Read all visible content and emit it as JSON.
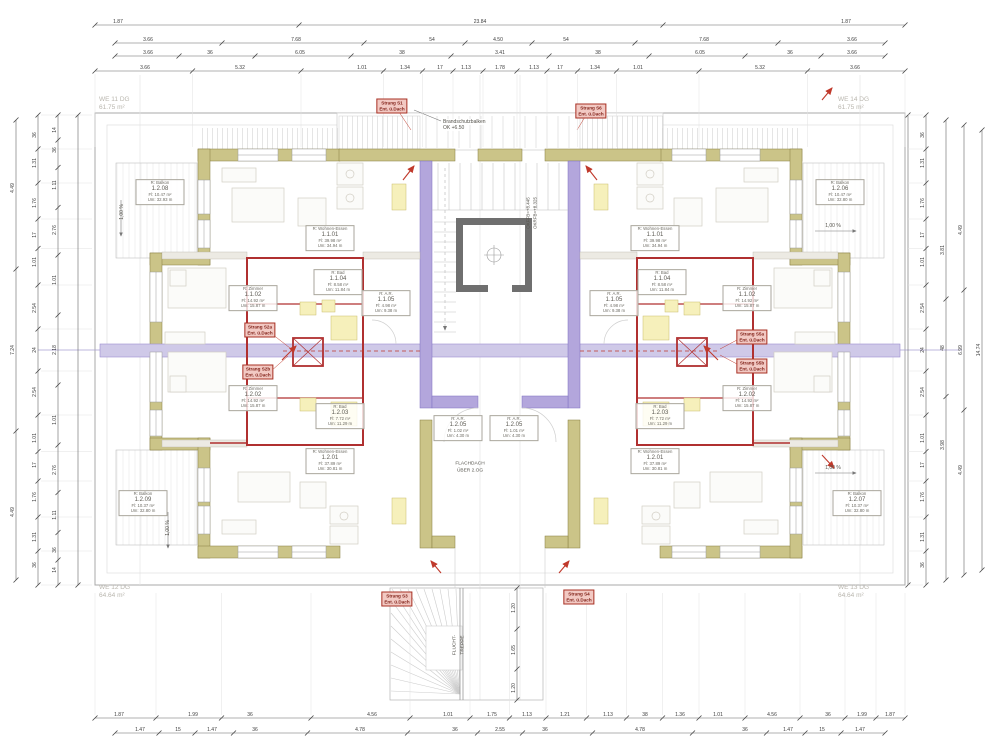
{
  "colors": {
    "exterior_wall": "#cbc488",
    "exterior_wall_edge": "#857c3e",
    "partition_wall": "#b3a6dc",
    "partition_edge": "#7d6fc0",
    "corridor_band": "#cfc9e8",
    "fire_wall_red": "#b03030",
    "elevator_gray": "#6f6f6f",
    "fixture_yellow": "#f6f0bb",
    "dim_line": "#666666",
    "strang_bg": "#f2c9c3",
    "unit_text_gray": "#b9b6ae"
  },
  "corner_units": [
    {
      "x": 99,
      "y": 96,
      "lines": [
        "WE 11 DG",
        "61.75 m²"
      ]
    },
    {
      "x": 838,
      "y": 96,
      "lines": [
        "WE 14 DG",
        "61.75 m²"
      ]
    },
    {
      "x": 99,
      "y": 584,
      "lines": [
        "WE 12 DG",
        "64.64 m²"
      ]
    },
    {
      "x": 838,
      "y": 584,
      "lines": [
        "WE 13 DG",
        "64.64 m²"
      ]
    }
  ],
  "rooms": [
    {
      "x": 160,
      "y": 192,
      "lines": [
        "R:  Balkon",
        "1.2.08",
        "Fl:  10.47 m²",
        "Um: 32.93 m"
      ]
    },
    {
      "x": 330,
      "y": 238,
      "lines": [
        "R:  Wohnen-Essen",
        "1.1.01",
        "Fl:  39.98 m²",
        "Um: 34.94 m"
      ]
    },
    {
      "x": 253,
      "y": 298,
      "lines": [
        "R:  Zimmer",
        "1.1.02",
        "Fl:  14.92 m²",
        "Um: 15.87 m"
      ]
    },
    {
      "x": 338,
      "y": 282,
      "lines": [
        "R:  Bad",
        "1.1.04",
        "Fl:  8.58 m²",
        "Um: 11.84 m"
      ]
    },
    {
      "x": 386,
      "y": 303,
      "lines": [
        "R:  A.R.",
        "1.1.05",
        "Fl:  4.98 m²",
        "Um: 9.38 m"
      ]
    },
    {
      "x": 253,
      "y": 398,
      "lines": [
        "R:  Zimmer",
        "1.2.02",
        "Fl:  14.92 m²",
        "Um: 15.87 m"
      ]
    },
    {
      "x": 340,
      "y": 416,
      "lines": [
        "R:  Bad",
        "1.2.03",
        "Fl:  7.72 m²",
        "Um: 11.29 m"
      ]
    },
    {
      "x": 330,
      "y": 461,
      "lines": [
        "R:  Wohnen-Essen",
        "1.2.01",
        "Fl:  37.89 m²",
        "Um: 30.81 m"
      ]
    },
    {
      "x": 143,
      "y": 503,
      "lines": [
        "R:  Balkon",
        "1.2.09",
        "Fl:  10.37 m²",
        "Um: 32.80 m"
      ]
    },
    {
      "x": 458,
      "y": 428,
      "lines": [
        "R:  A.R.",
        "1.2.05",
        "Fl:  1.02 m²",
        "Um: 4.30 m"
      ]
    },
    {
      "x": 514,
      "y": 428,
      "lines": [
        "R:  A.R.",
        "1.2.05",
        "Fl:  1.01 m²",
        "Um: 4.30 m"
      ]
    },
    {
      "x": 840,
      "y": 192,
      "lines": [
        "R:  Balkon",
        "1.2.06",
        "Fl:  10.47 m²",
        "Um: 32.80 m"
      ]
    },
    {
      "x": 655,
      "y": 238,
      "lines": [
        "R:  Wohnen-Essen",
        "1.1.01",
        "Fl:  39.98 m²",
        "Um: 34.94 m"
      ]
    },
    {
      "x": 747,
      "y": 298,
      "lines": [
        "R:  Zimmer",
        "1.1.02",
        "Fl:  14.92 m²",
        "Um: 15.87 m"
      ]
    },
    {
      "x": 662,
      "y": 282,
      "lines": [
        "R:  Bad",
        "1.1.04",
        "Fl:  8.58 m²",
        "Um: 11.84 m"
      ]
    },
    {
      "x": 614,
      "y": 303,
      "lines": [
        "R:  A.R.",
        "1.1.05",
        "Fl:  4.98 m²",
        "Um: 9.38 m"
      ]
    },
    {
      "x": 747,
      "y": 398,
      "lines": [
        "R:  Zimmer",
        "1.2.02",
        "Fl:  14.92 m²",
        "Um: 15.87 m"
      ]
    },
    {
      "x": 660,
      "y": 416,
      "lines": [
        "R:  Bad",
        "1.2.03",
        "Fl:  7.72 m²",
        "Um: 11.29 m"
      ]
    },
    {
      "x": 655,
      "y": 461,
      "lines": [
        "R:  Wohnen-Essen",
        "1.2.01",
        "Fl:  37.89 m²",
        "Um: 30.81 m"
      ]
    },
    {
      "x": 857,
      "y": 503,
      "lines": [
        "R:  Balkon",
        "1.2.07",
        "Fl:  10.37 m²",
        "Um: 32.80 m"
      ]
    }
  ],
  "strang": [
    {
      "x": 392,
      "y": 106,
      "lines": [
        "Strang S1",
        "Ent. ü.Dach"
      ]
    },
    {
      "x": 591,
      "y": 111,
      "lines": [
        "Strang S6",
        "Ent. ü.Dach"
      ]
    },
    {
      "x": 260,
      "y": 330,
      "lines": [
        "Strang S2a",
        "Ent. ü.Dach"
      ]
    },
    {
      "x": 258,
      "y": 372,
      "lines": [
        "Strang S2b",
        "Ent. ü.Dach"
      ]
    },
    {
      "x": 752,
      "y": 337,
      "lines": [
        "Strang S5a",
        "Ent. ü.Dach"
      ]
    },
    {
      "x": 752,
      "y": 366,
      "lines": [
        "Strang S5b",
        "Ent. ü.Dach"
      ]
    },
    {
      "x": 397,
      "y": 599,
      "lines": [
        "Strang S3",
        "Ent. ü.Dach"
      ]
    },
    {
      "x": 579,
      "y": 597,
      "lines": [
        "Strang S4",
        "Ent. ü.Dach"
      ]
    }
  ],
  "notes": [
    {
      "x": 443,
      "y": 119,
      "t": "Brandschutzbalken",
      "s": 5,
      "a": "left",
      "bg": true
    },
    {
      "x": 443,
      "y": 125,
      "t": "OK +6.50",
      "s": 5,
      "a": "left",
      "bg": true
    },
    {
      "x": 528,
      "y": 213,
      "t": "OKFFB=+8.445",
      "s": 4.5,
      "r": -90
    },
    {
      "x": 535,
      "y": 213,
      "t": "OKRFB=+8.325",
      "s": 4.5,
      "r": -90
    },
    {
      "x": 470,
      "y": 464,
      "t": "FLACHDACH",
      "s": 4.8,
      "a": "center"
    },
    {
      "x": 470,
      "y": 471,
      "t": "ÜBER 2.OG",
      "s": 4.8,
      "a": "center"
    },
    {
      "x": 455,
      "y": 645,
      "t": "FLUCHT-",
      "s": 4.8,
      "r": -90
    },
    {
      "x": 463,
      "y": 645,
      "t": "TREPPE",
      "s": 4.8,
      "r": -90
    },
    {
      "x": 833,
      "y": 226,
      "t": "1,00 %",
      "s": 5,
      "a": "center"
    },
    {
      "x": 833,
      "y": 468,
      "t": "1,00 %",
      "s": 5,
      "a": "center"
    },
    {
      "x": 122,
      "y": 212,
      "t": "1,00 %",
      "s": 5,
      "r": -90
    },
    {
      "x": 168,
      "y": 528,
      "t": "1,00 %",
      "s": 5,
      "r": -90
    }
  ],
  "dim_rows": [
    {
      "y": 25,
      "x1": 95,
      "x2": 905,
      "labels": [
        {
          "x": 118,
          "t": "1.87"
        },
        {
          "x": 480,
          "t": "23.84"
        },
        {
          "x": 846,
          "t": "1.87"
        }
      ]
    },
    {
      "y": 43,
      "x1": 115,
      "x2": 885,
      "labels": [
        {
          "x": 148,
          "t": "3.66"
        },
        {
          "x": 296,
          "t": "7.68"
        },
        {
          "x": 432,
          "t": "54"
        },
        {
          "x": 498,
          "t": "4.50"
        },
        {
          "x": 566,
          "t": "54"
        },
        {
          "x": 704,
          "t": "7.68"
        },
        {
          "x": 852,
          "t": "3.66"
        }
      ]
    },
    {
      "y": 56,
      "x1": 115,
      "x2": 885,
      "labels": [
        {
          "x": 148,
          "t": "3.66"
        },
        {
          "x": 210,
          "t": "36"
        },
        {
          "x": 300,
          "t": "6.05"
        },
        {
          "x": 402,
          "t": "38"
        },
        {
          "x": 500,
          "t": "3.41"
        },
        {
          "x": 598,
          "t": "38"
        },
        {
          "x": 700,
          "t": "6.05"
        },
        {
          "x": 790,
          "t": "36"
        },
        {
          "x": 852,
          "t": "3.66"
        }
      ]
    },
    {
      "y": 71,
      "x1": 95,
      "x2": 905,
      "witnessTo": 150,
      "labels": [
        {
          "x": 145,
          "t": "3.66"
        },
        {
          "x": 240,
          "t": "5.32"
        },
        {
          "x": 362,
          "t": "1.01"
        },
        {
          "x": 405,
          "t": "1.34"
        },
        {
          "x": 440,
          "t": "17"
        },
        {
          "x": 466,
          "t": "1.13"
        },
        {
          "x": 500,
          "t": "1.78"
        },
        {
          "x": 534,
          "t": "1.13"
        },
        {
          "x": 560,
          "t": "17"
        },
        {
          "x": 595,
          "t": "1.34"
        },
        {
          "x": 638,
          "t": "1.01"
        },
        {
          "x": 760,
          "t": "5.32"
        },
        {
          "x": 855,
          "t": "3.66"
        }
      ]
    },
    {
      "y": 718,
      "x1": 95,
      "x2": 905,
      "witnessTo": 590,
      "labels": [
        {
          "x": 119,
          "t": "1.87"
        },
        {
          "x": 193,
          "t": "1.99"
        },
        {
          "x": 250,
          "t": "36"
        },
        {
          "x": 372,
          "t": "4.56"
        },
        {
          "x": 448,
          "t": "1.01"
        },
        {
          "x": 492,
          "t": "1.75"
        },
        {
          "x": 527,
          "t": "1.13"
        },
        {
          "x": 565,
          "t": "1.21"
        },
        {
          "x": 608,
          "t": "1.13"
        },
        {
          "x": 645,
          "t": "38"
        },
        {
          "x": 680,
          "t": "1.36"
        },
        {
          "x": 718,
          "t": "1.01"
        },
        {
          "x": 772,
          "t": "4.56"
        },
        {
          "x": 828,
          "t": "36"
        },
        {
          "x": 862,
          "t": "1.99"
        },
        {
          "x": 890,
          "t": "1.87"
        }
      ]
    },
    {
      "y": 733,
      "x1": 115,
      "x2": 885,
      "labels": [
        {
          "x": 140,
          "t": "1.47"
        },
        {
          "x": 178,
          "t": "15"
        },
        {
          "x": 212,
          "t": "1.47"
        },
        {
          "x": 255,
          "t": "36"
        },
        {
          "x": 360,
          "t": "4.78"
        },
        {
          "x": 455,
          "t": "36"
        },
        {
          "x": 500,
          "t": "2.55"
        },
        {
          "x": 545,
          "t": "36"
        },
        {
          "x": 640,
          "t": "4.78"
        },
        {
          "x": 745,
          "t": "36"
        },
        {
          "x": 788,
          "t": "1.47"
        },
        {
          "x": 822,
          "t": "15"
        },
        {
          "x": 860,
          "t": "1.47"
        }
      ]
    }
  ],
  "dim_cols": [
    {
      "x": 16,
      "y1": 120,
      "y2": 580,
      "labels": [
        {
          "y": 188,
          "t": "4.49"
        },
        {
          "y": 350,
          "t": "7.24"
        },
        {
          "y": 512,
          "t": "4.49"
        }
      ]
    },
    {
      "x": 38,
      "y1": 115,
      "y2": 585,
      "witnessTo": 95,
      "labels": [
        {
          "y": 135,
          "t": "36"
        },
        {
          "y": 163,
          "t": "1.31"
        },
        {
          "y": 203,
          "t": "1.76"
        },
        {
          "y": 235,
          "t": "17"
        },
        {
          "y": 262,
          "t": "1.01"
        },
        {
          "y": 308,
          "t": "2.54"
        },
        {
          "y": 350,
          "t": "24"
        },
        {
          "y": 392,
          "t": "2.54"
        },
        {
          "y": 438,
          "t": "1.01"
        },
        {
          "y": 465,
          "t": "17"
        },
        {
          "y": 497,
          "t": "1.76"
        },
        {
          "y": 537,
          "t": "1.31"
        },
        {
          "y": 565,
          "t": "36"
        }
      ]
    },
    {
      "x": 58,
      "y1": 115,
      "y2": 585,
      "labels": [
        {
          "y": 130,
          "t": "14"
        },
        {
          "y": 150,
          "t": "36"
        },
        {
          "y": 185,
          "t": "1.11"
        },
        {
          "y": 230,
          "t": "2.76"
        },
        {
          "y": 280,
          "t": "1.01"
        },
        {
          "y": 350,
          "t": "2.18"
        },
        {
          "y": 420,
          "t": "1.01"
        },
        {
          "y": 470,
          "t": "2.76"
        },
        {
          "y": 515,
          "t": "1.11"
        },
        {
          "y": 550,
          "t": "36"
        },
        {
          "y": 570,
          "t": "14"
        }
      ]
    },
    {
      "x": 78,
      "y1": 115,
      "y2": 585,
      "labels": []
    },
    {
      "x": 908,
      "y1": 115,
      "y2": 585,
      "labels": []
    },
    {
      "x": 926,
      "y1": 115,
      "y2": 585,
      "witnessTo": 905,
      "labels": [
        {
          "y": 135,
          "t": "36"
        },
        {
          "y": 163,
          "t": "1.31"
        },
        {
          "y": 203,
          "t": "1.76"
        },
        {
          "y": 235,
          "t": "17"
        },
        {
          "y": 262,
          "t": "1.01"
        },
        {
          "y": 308,
          "t": "2.54"
        },
        {
          "y": 350,
          "t": "24"
        },
        {
          "y": 392,
          "t": "2.54"
        },
        {
          "y": 438,
          "t": "1.01"
        },
        {
          "y": 465,
          "t": "17"
        },
        {
          "y": 497,
          "t": "1.76"
        },
        {
          "y": 537,
          "t": "1.31"
        },
        {
          "y": 565,
          "t": "36"
        }
      ]
    },
    {
      "x": 946,
      "y1": 120,
      "y2": 580,
      "labels": [
        {
          "y": 250,
          "t": "3.81"
        },
        {
          "y": 348,
          "t": "48"
        },
        {
          "y": 445,
          "t": "3.98"
        }
      ]
    },
    {
      "x": 964,
      "y1": 125,
      "y2": 575,
      "labels": [
        {
          "y": 230,
          "t": "4.49"
        },
        {
          "y": 350,
          "t": "6.99"
        },
        {
          "y": 470,
          "t": "4.49"
        }
      ]
    },
    {
      "x": 982,
      "y1": 130,
      "y2": 570,
      "labels": [
        {
          "y": 350,
          "t": "14.74"
        }
      ]
    },
    {
      "x": 517,
      "y1": 588,
      "y2": 700,
      "labels": [
        {
          "y": 608,
          "t": "1.20"
        },
        {
          "y": 650,
          "t": "1.65"
        },
        {
          "y": 688,
          "t": "1.20"
        }
      ]
    }
  ]
}
